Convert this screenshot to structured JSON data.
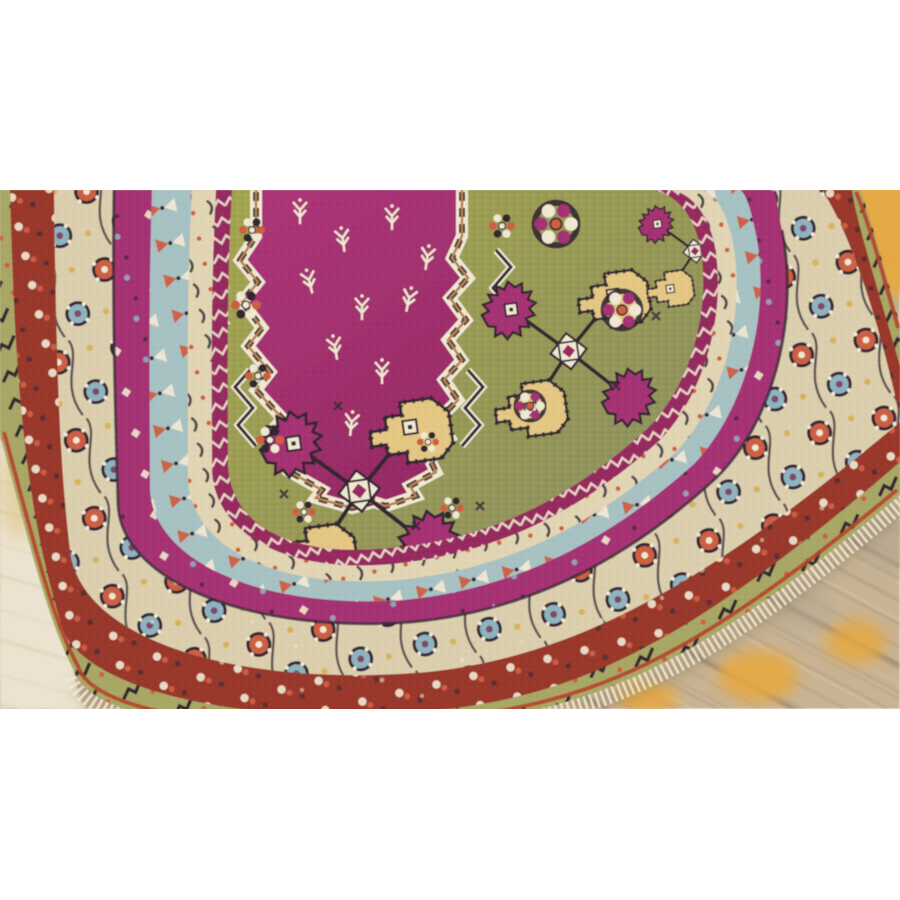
{
  "scene": {
    "type": "photograph",
    "subject": "Antique Anatolian prayer rug shown at a diagonal angle on a yellow-painted wood plank floor",
    "alt": "Late 19th century Anatolian carpet with magenta stepped medallion, olive-green field, hooked yellow and magenta motifs, and multiple ornamented borders, photographed lying on worn yellow-painted floorboards; white bands above and below the photo"
  },
  "photo": {
    "top_px": 190,
    "height_px": 519,
    "width_px": 900
  },
  "palette": {
    "page_white": "#ffffff",
    "wood_base": "#c8b394",
    "wood_seam": "#94836a",
    "wood_streak": "#dbcbaa",
    "wood_yellow": "#e7a83c",
    "wood_gray": "#b3a78f",
    "wood_pale": "#ebe3cf",
    "wood_pale_seam": "#d7c9ad",
    "rug_magenta": "#a53273",
    "rug_magenta_deep": "#96295f",
    "field_olive": "#a2a44f",
    "field_sage": "#8e9160",
    "cream": "#e2d5b4",
    "cream_bright": "#f0e8d2",
    "blue_band": "#a7c2c3",
    "red_band": "#99392a",
    "red_edge": "#b5452c",
    "green_outer": "#a8a765",
    "floral_ground": "#dccfae",
    "motif_yellow": "#e4c783",
    "outline_dark": "#332833",
    "accent_coral": "#cd5f43",
    "accent_blue": "#8fb3bf",
    "accent_purple": "#7c4a68",
    "accent_gold": "#d8b35c",
    "accent_tan": "#b5814f",
    "shadow": "#7d6f58"
  },
  "rug": {
    "description": "Diagonally placed rug; border system wraps a bottom-left corner, field occupies upper middle with stepped magenta medallion and two hooked guls",
    "bands": [
      {
        "name": "outer-green-band",
        "boundary": "b0",
        "color": "green_outer",
        "pattern": "pat-green"
      },
      {
        "name": "red-flower-band",
        "boundary": "b2",
        "color": "red_band",
        "pattern": "pat-red"
      },
      {
        "name": "main-floral-border",
        "boundary": "b3",
        "color": "floral_ground",
        "pattern": "pat-floral"
      },
      {
        "name": "magenta-band",
        "boundary": "b4",
        "color": "rug_magenta",
        "pattern": "pat-mag"
      },
      {
        "name": "light-blue-band",
        "boundary": "b5",
        "color": "blue_band",
        "pattern": "pat-blue"
      },
      {
        "name": "cream-minor-band",
        "boundary": "b6",
        "color": "cream",
        "pattern": "pat-cream"
      },
      {
        "name": "inner-magenta-band",
        "boundary": "b7",
        "color": "rug_magenta_deep",
        "pattern": "pat-zig"
      },
      {
        "name": "field",
        "boundary": "b8",
        "gradient": "fieldGrad",
        "pattern": "pat-weave"
      }
    ]
  }
}
